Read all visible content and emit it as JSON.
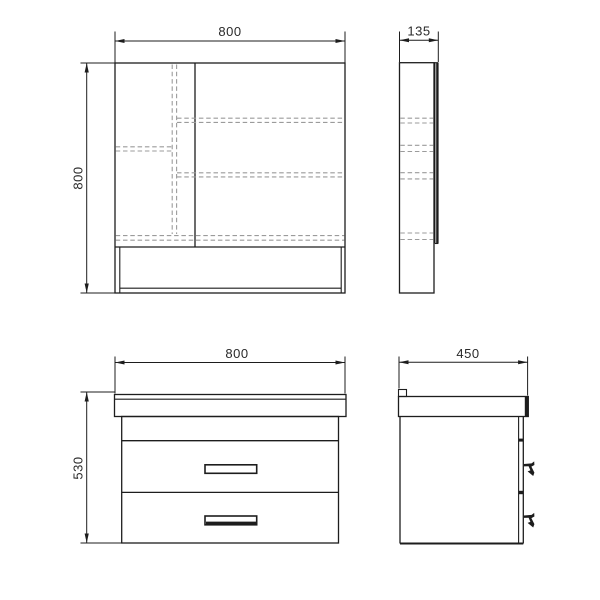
{
  "drawing": {
    "type": "technical-orthographic-drawing",
    "views": {
      "mirror_front": {
        "width": "800",
        "height": "800"
      },
      "mirror_side": {
        "depth": "135"
      },
      "vanity_front": {
        "width": "800",
        "height": "530"
      },
      "vanity_side": {
        "depth": "450"
      }
    },
    "colors": {
      "line": "#1d1d1d",
      "hidden_line": "#9b9b9b",
      "text": "#2a2a2a",
      "background": "#ffffff"
    }
  }
}
